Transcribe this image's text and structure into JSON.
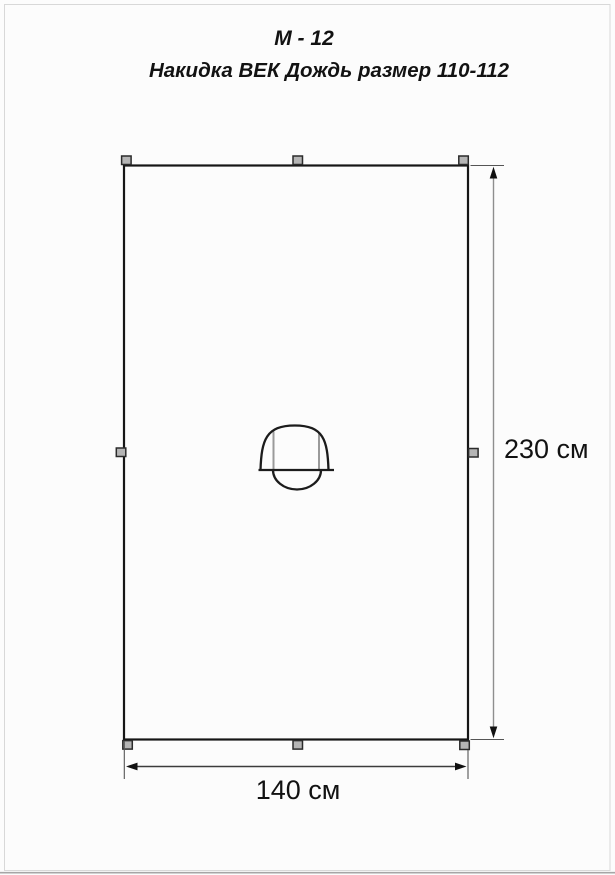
{
  "header": {
    "model": "М - 12",
    "product": "Накидка ВЕК Дождь размер 110-112"
  },
  "pattern": {
    "description": "Flat rectangular rain-cape panel with centered hood opening",
    "height": {
      "label": "230 см",
      "value_cm": 230
    },
    "width": {
      "label": "140 см",
      "value_cm": 140
    },
    "attachment_markers_count": 8
  },
  "colors": {
    "outline": "#161616",
    "marker_fill": "#b5b5b5",
    "vertical_dimension_line": "#8e8e8e",
    "horizontal_dimension_line": "#3c3c3c",
    "hood_fold_line": "#9a9a9a",
    "page_border": "#d8d8d8",
    "text": "#121212",
    "background": "#fcfcfc"
  }
}
